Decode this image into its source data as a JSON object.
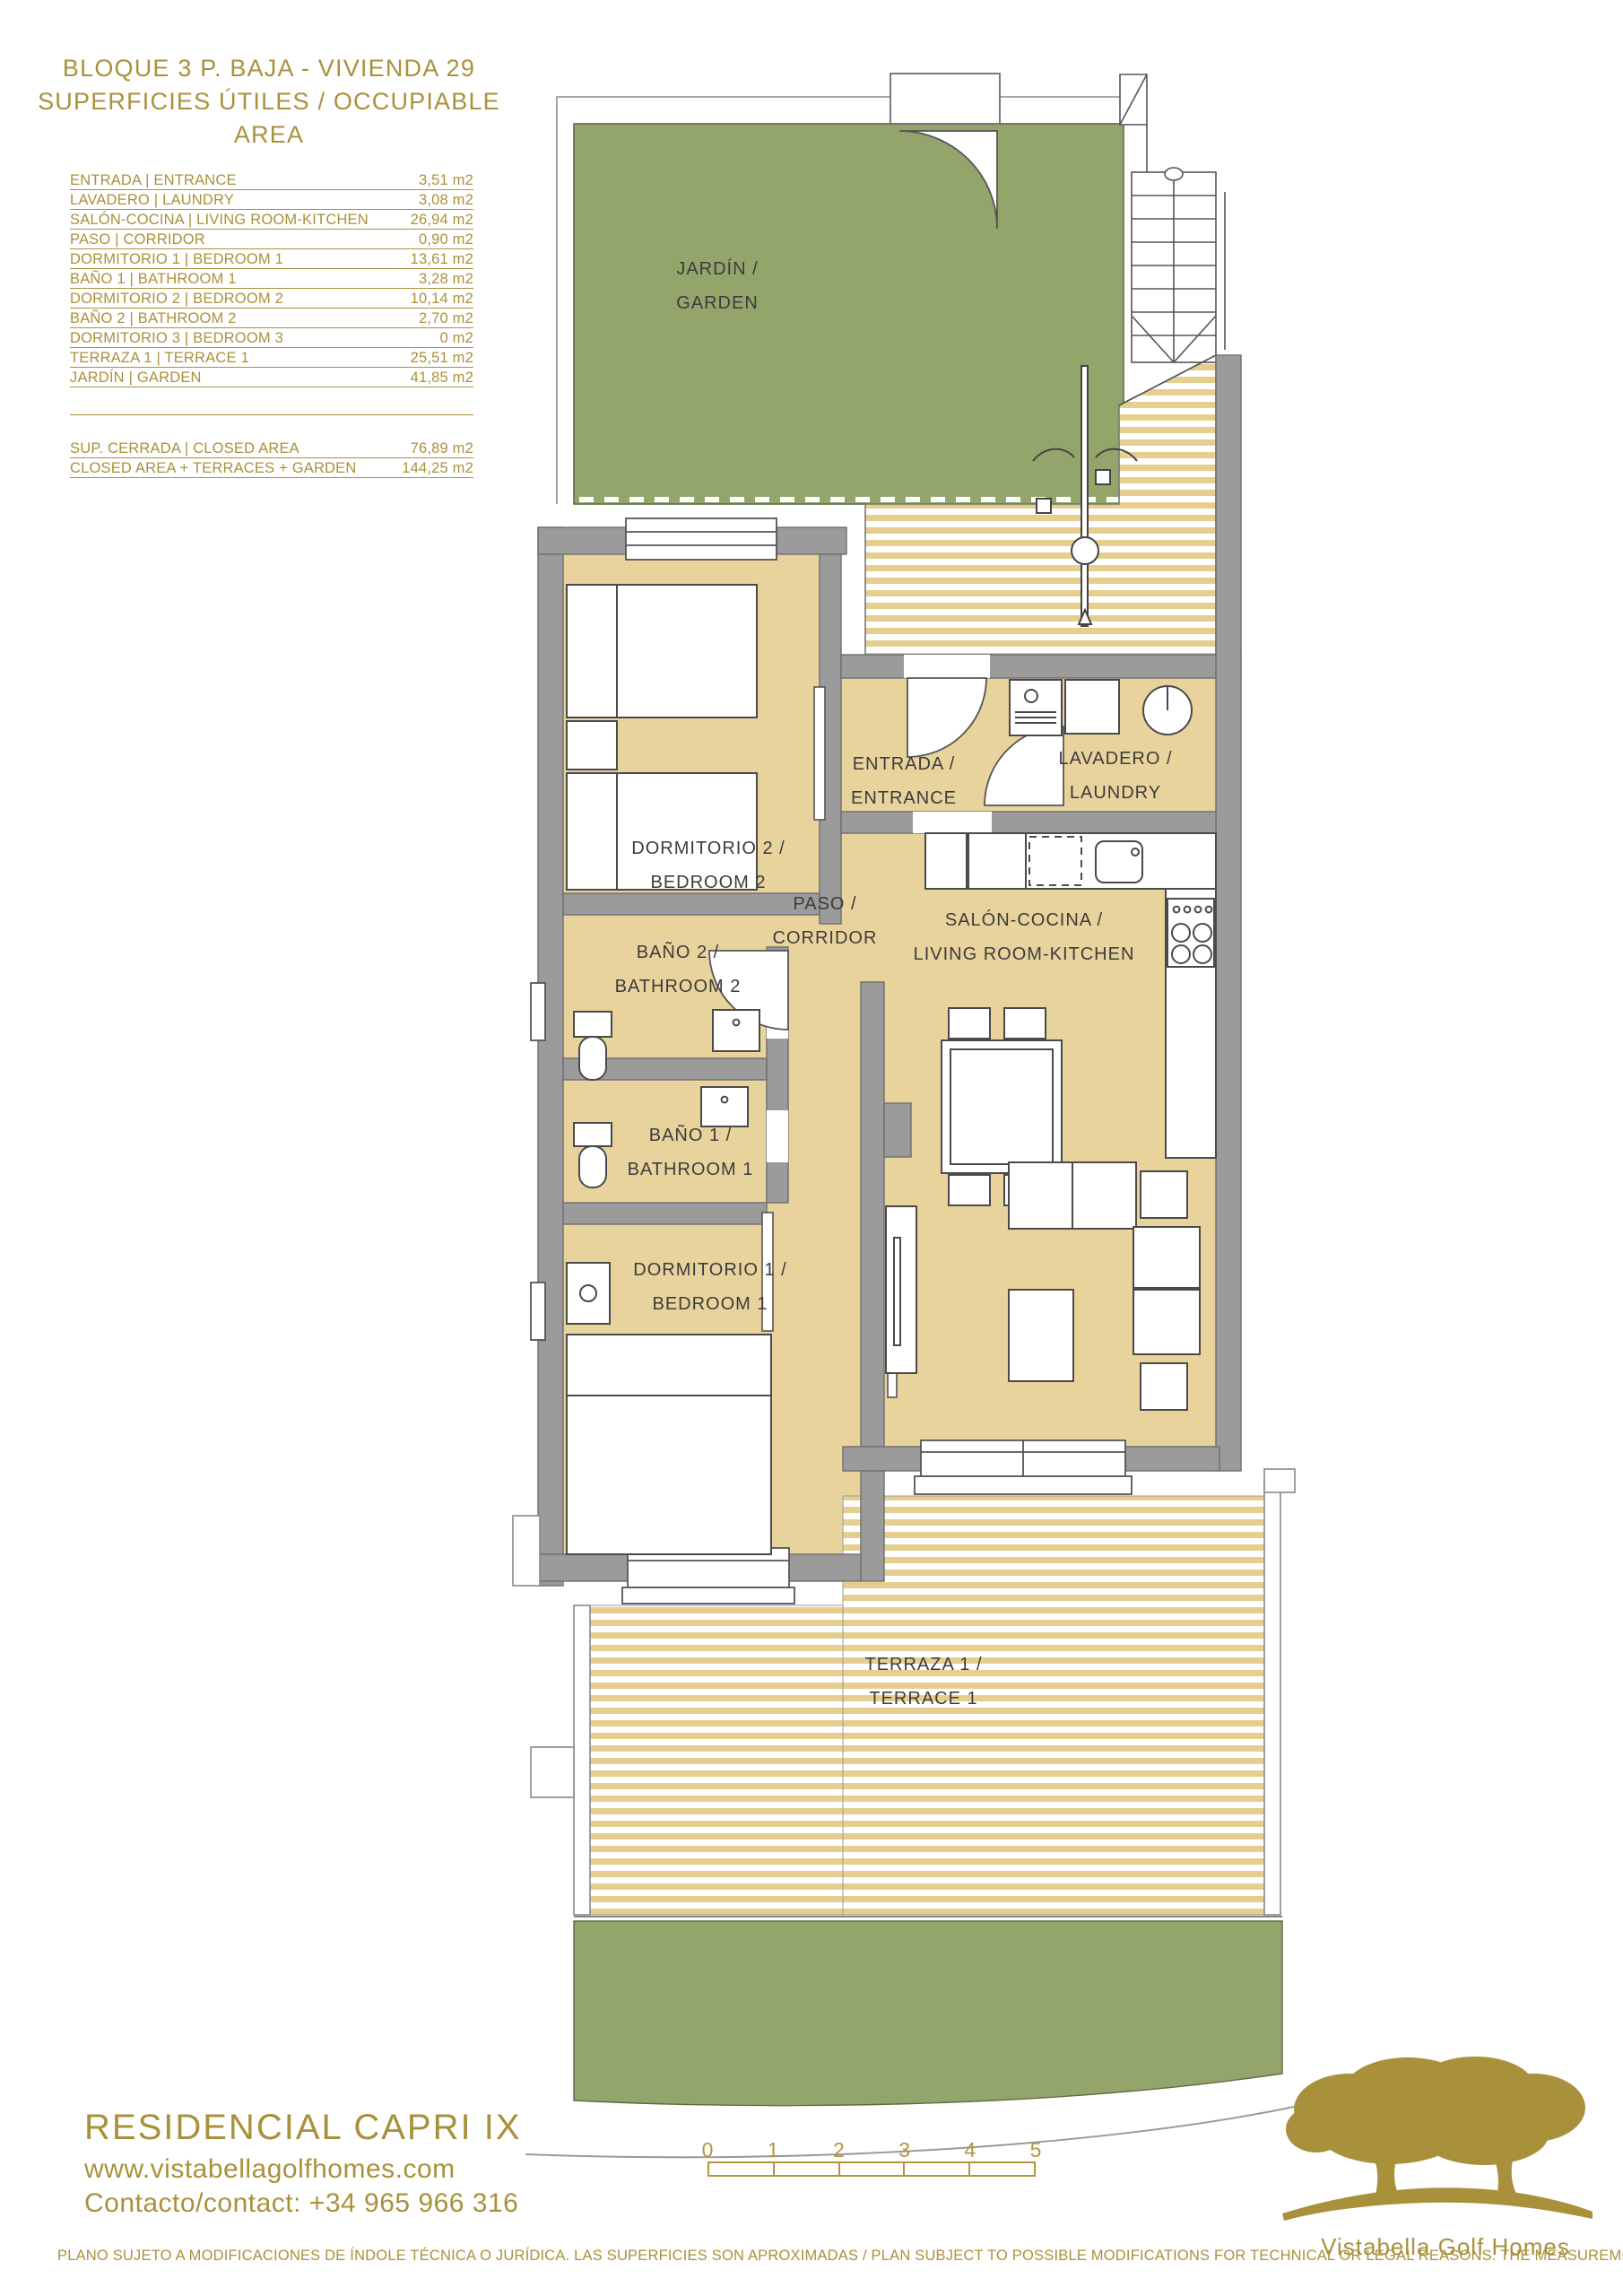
{
  "colors": {
    "gold": "#a9913c",
    "garden_green": "#93a56b",
    "floor_tan": "#e9d39d",
    "stripe_tan": "#e6cf8e",
    "wall_gray": "#9b9b9b",
    "label_gray": "#3c3c3c"
  },
  "header": {
    "title_line1": "BLOQUE 3 P. BAJA - VIVIENDA 29",
    "title_line2": "SUPERFICIES ÚTILES / OCCUPIABLE AREA"
  },
  "area_table": {
    "rows": [
      {
        "label": "ENTRADA | ENTRANCE",
        "value": "3,51 m2"
      },
      {
        "label": "LAVADERO | LAUNDRY",
        "value": "3,08 m2"
      },
      {
        "label": "SALÓN-COCINA | LIVING ROOM-KITCHEN",
        "value": "26,94 m2"
      },
      {
        "label": "PASO | CORRIDOR",
        "value": "0,90 m2"
      },
      {
        "label": "DORMITORIO 1 | BEDROOM 1",
        "value": "13,61 m2"
      },
      {
        "label": "BAÑO 1 | BATHROOM 1",
        "value": "3,28 m2"
      },
      {
        "label": "DORMITORIO 2 | BEDROOM 2",
        "value": "10,14 m2"
      },
      {
        "label": "BAÑO 2 | BATHROOM 2",
        "value": "2,70 m2"
      },
      {
        "label": "DORMITORIO 3 | BEDROOM 3",
        "value": "0 m2"
      },
      {
        "label": "TERRAZA 1 | TERRACE 1",
        "value": "25,51 m2"
      },
      {
        "label": "JARDÍN | GARDEN",
        "value": "41,85 m2"
      }
    ],
    "summary": [
      {
        "label": "SUP. CERRADA | CLOSED AREA",
        "value": "76,89 m2"
      },
      {
        "label": "CLOSED AREA + TERRACES + GARDEN",
        "value": "144,25 m2"
      }
    ]
  },
  "plan": {
    "rooms": {
      "garden": {
        "line1": "JARDÍN /",
        "line2": "GARDEN"
      },
      "dormitorio2": {
        "line1": "DORMITORIO 2 /",
        "line2": "BEDROOM 2"
      },
      "entrada": {
        "line1": "ENTRADA /",
        "line2": "ENTRANCE"
      },
      "lavadero": {
        "line1": "LAVADERO /",
        "line2": "LAUNDRY"
      },
      "bano2": {
        "line1": "BAÑO 2 /",
        "line2": "BATHROOM 2"
      },
      "paso": {
        "line1": "PASO /",
        "line2": "CORRIDOR"
      },
      "salon": {
        "line1": "SALÓN-COCINA /",
        "line2": "LIVING ROOM-KITCHEN"
      },
      "bano1": {
        "line1": "BAÑO 1 /",
        "line2": "BATHROOM 1"
      },
      "dormitorio1": {
        "line1": "DORMITORIO 1 /",
        "line2": "BEDROOM 1"
      },
      "terraza": {
        "line1": "TERRAZA 1 /",
        "line2": "TERRACE 1"
      }
    }
  },
  "scale_bar": {
    "labels": [
      "0",
      "1",
      "2",
      "3",
      "4",
      "5"
    ]
  },
  "footer": {
    "project": "RESIDENCIAL CAPRI IX",
    "website": "www.vistabellagolfhomes.com",
    "contact": "Contacto/contact: +34 965 966 316",
    "disclaimer": "PLANO SUJETO A MODIFICACIONES DE ÍNDOLE TÉCNICA O JURÍDICA. LAS SUPERFICIES SON APROXIMADAS / PLAN SUBJECT TO POSSIBLE MODIFICATIONS FOR TECHNICAL OR LEGAL REASONS. THE MEASUREMENTS SHOWN ARE APPROXIMATE",
    "logo_text": "Vistabella Golf Homes"
  }
}
